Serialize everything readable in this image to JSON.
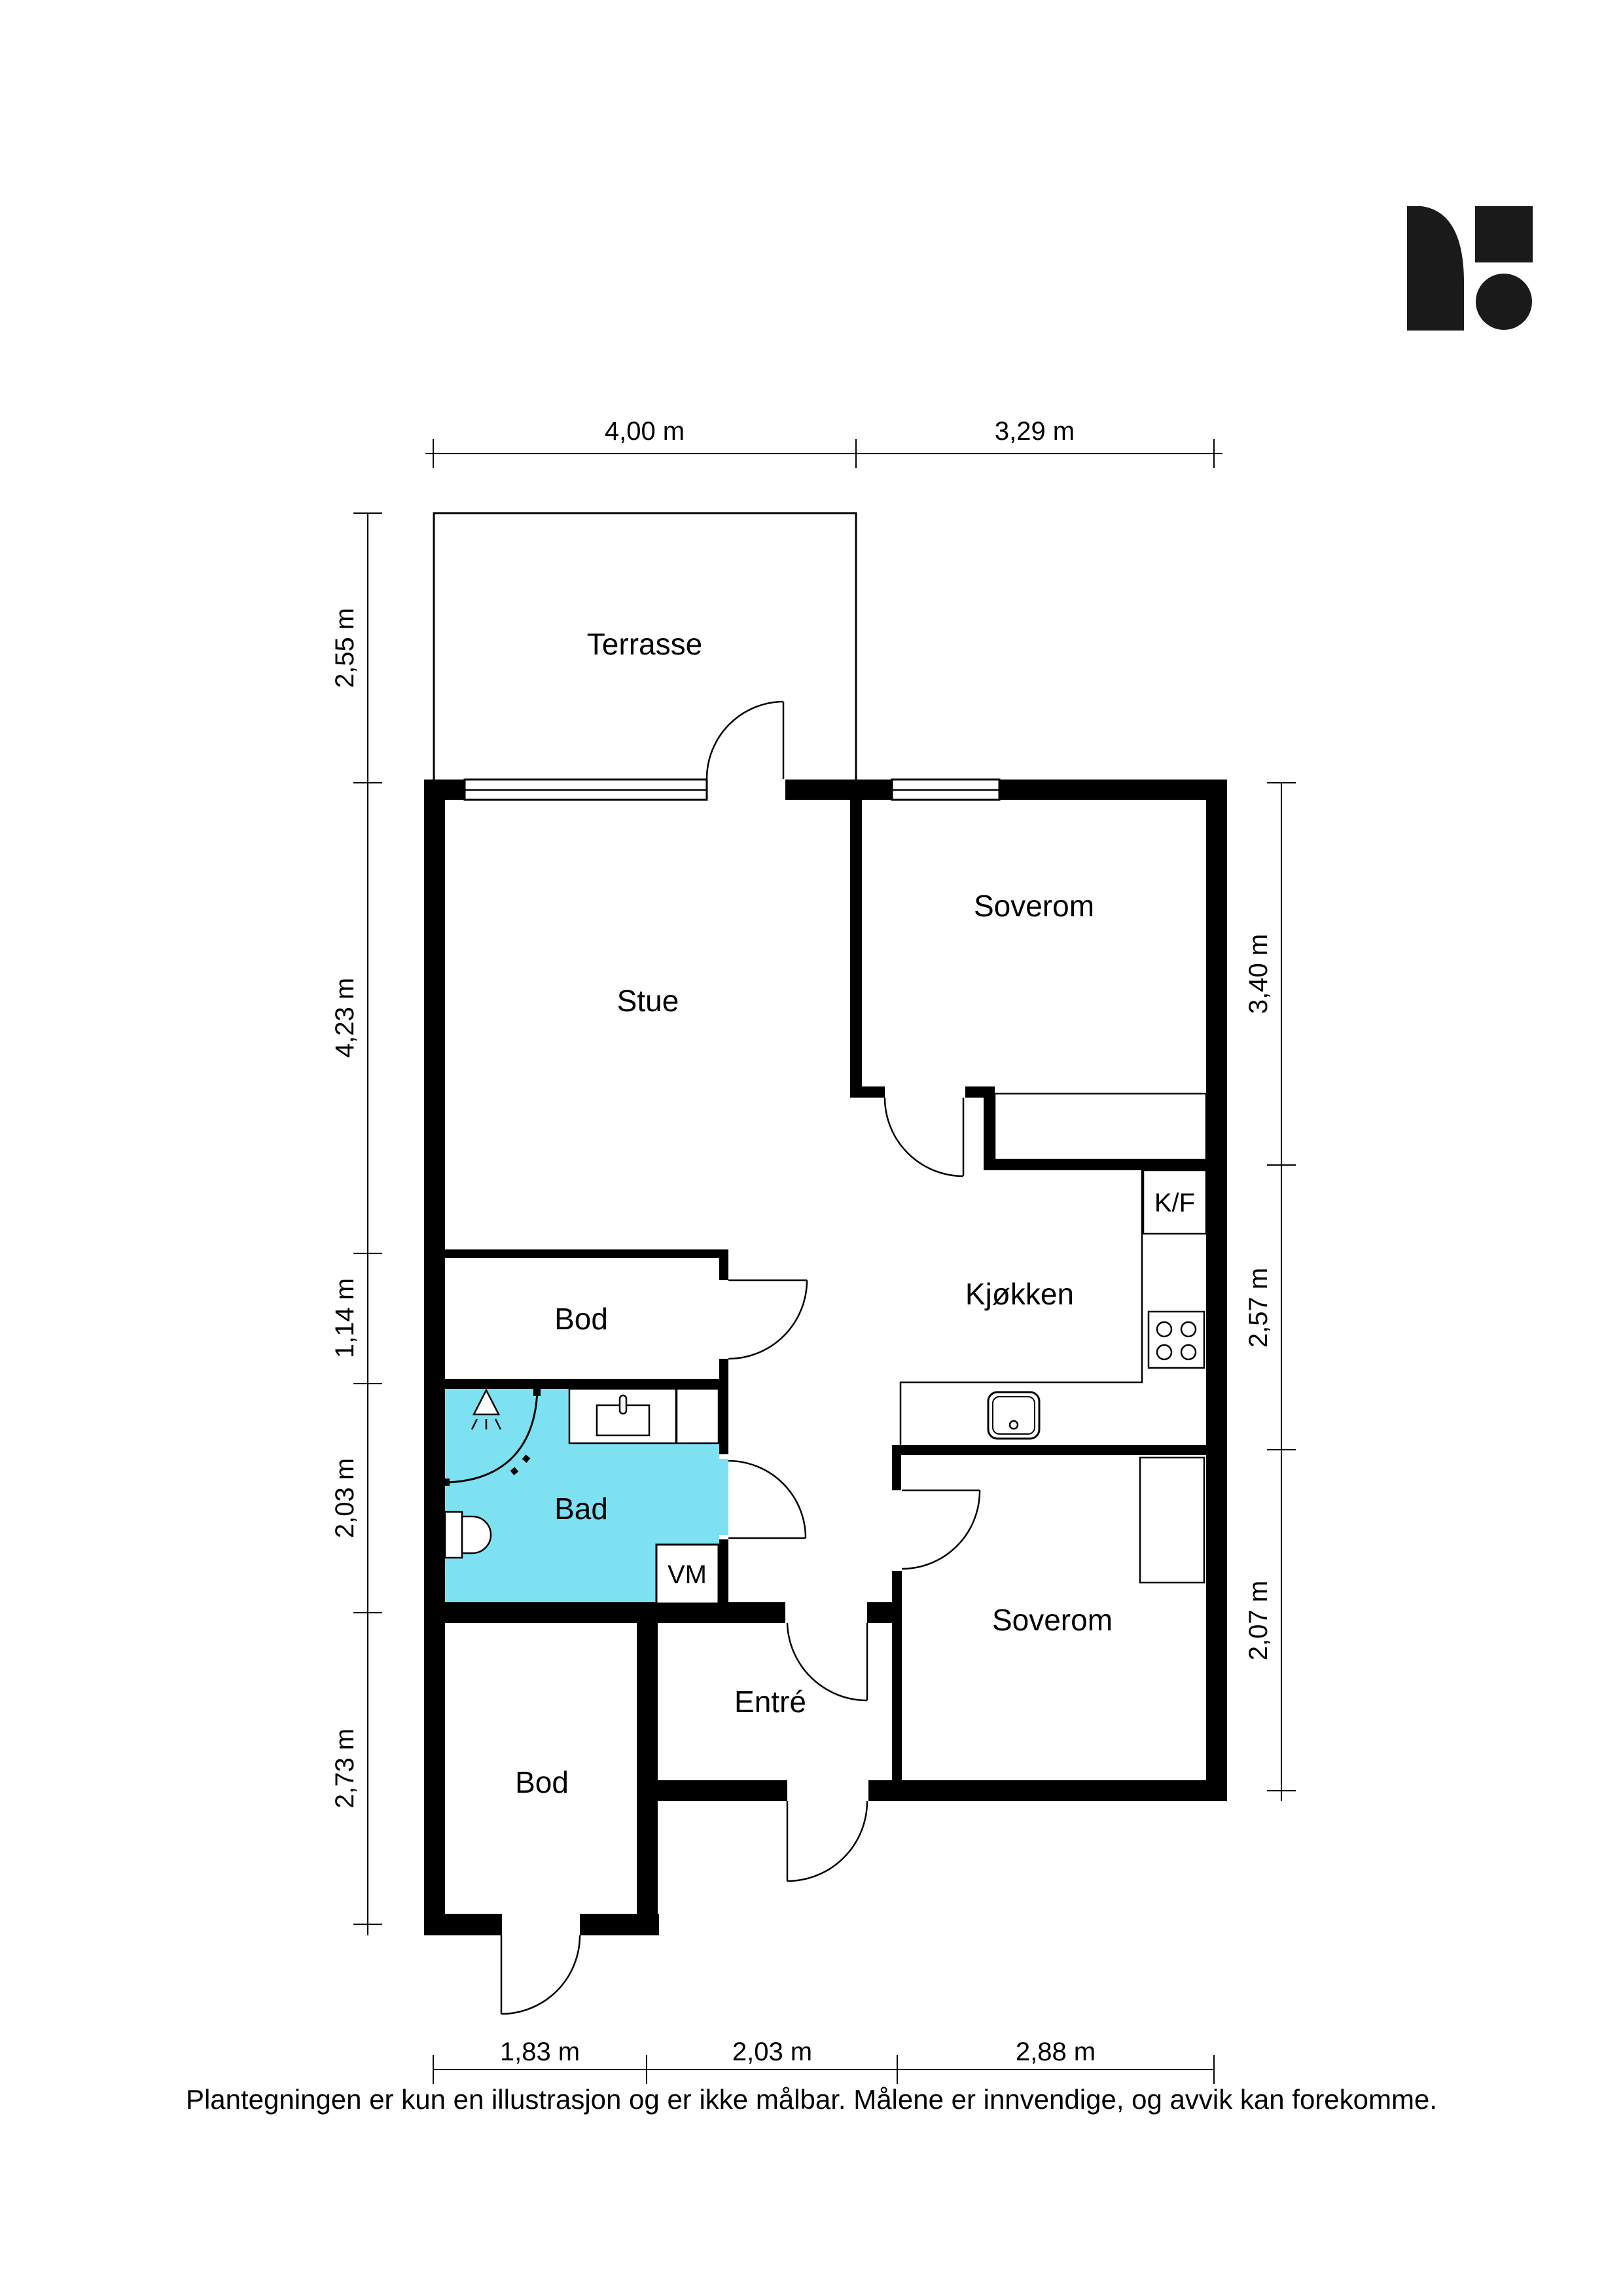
{
  "floorplan": {
    "rooms": {
      "terrasse": "Terrasse",
      "stue": "Stue",
      "soverom1": "Soverom",
      "kjokken": "Kjøkken",
      "kf": "K/F",
      "bod1": "Bod",
      "bad": "Bad",
      "vm": "VM",
      "entre": "Entré",
      "soverom2": "Soverom",
      "bod2": "Bod"
    },
    "dims": {
      "top": [
        "4,00 m",
        "3,29 m"
      ],
      "bottom": [
        "1,83 m",
        "2,03 m",
        "2,88 m"
      ],
      "left": [
        "2,55 m",
        "4,23 m",
        "1,14 m",
        "2,03 m",
        "2,73 m"
      ],
      "right": [
        "3,40 m",
        "2,57 m",
        "2,07 m"
      ]
    },
    "colors": {
      "bad_fill": "#7de1f2",
      "wall": "#000000"
    },
    "footer": "Plantegningen er kun en illustrasjon og er ikke målbar. Målene er innvendige, og avvik kan forekomme."
  }
}
